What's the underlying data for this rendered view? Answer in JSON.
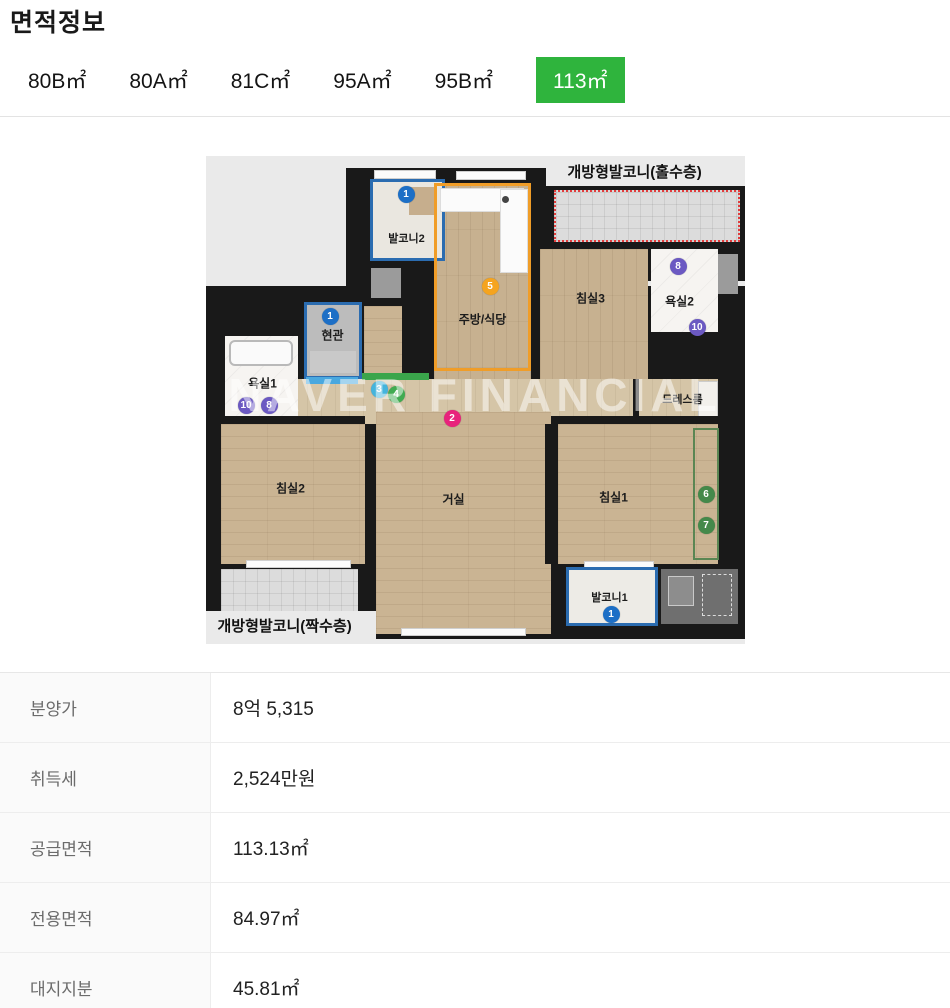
{
  "page": {
    "title": "면적정보"
  },
  "tabs": [
    {
      "label": "80B㎡"
    },
    {
      "label": "80A㎡"
    },
    {
      "label": "81C㎡"
    },
    {
      "label": "95A㎡"
    },
    {
      "label": "95B㎡"
    },
    {
      "label": "113㎡",
      "active": true
    }
  ],
  "accent_color": "#2fb43d",
  "floorplan": {
    "watermark": "NAVER FINANCIAL",
    "balcony_top_label": "개방형발코니(홀수층)",
    "balcony_bottom_label": "개방형발코니(짝수층)",
    "rooms": {
      "balcony2": "발코니2",
      "kitchen": "주방/식당",
      "bedroom3": "침실3",
      "bathroom2": "욕실2",
      "dressroom": "드레스룸",
      "entrance": "현관",
      "bathroom1": "욕실1",
      "bedroom2": "침실2",
      "living": "거실",
      "bedroom1": "침실1",
      "balcony1": "발코니1"
    },
    "markers": {
      "m1": "1",
      "m2": "2",
      "m3": "3",
      "m4": "4",
      "m5": "5",
      "m6": "6",
      "m7": "7",
      "m8": "8",
      "m10": "10"
    }
  },
  "table": {
    "rows": [
      {
        "label": "분양가",
        "value": "8억 5,315"
      },
      {
        "label": "취득세",
        "value": "2,524만원"
      },
      {
        "label": "공급면적",
        "value": "113.13㎡"
      },
      {
        "label": "전용면적",
        "value": "84.97㎡"
      },
      {
        "label": "대지지분",
        "value": "45.81㎡"
      }
    ]
  }
}
